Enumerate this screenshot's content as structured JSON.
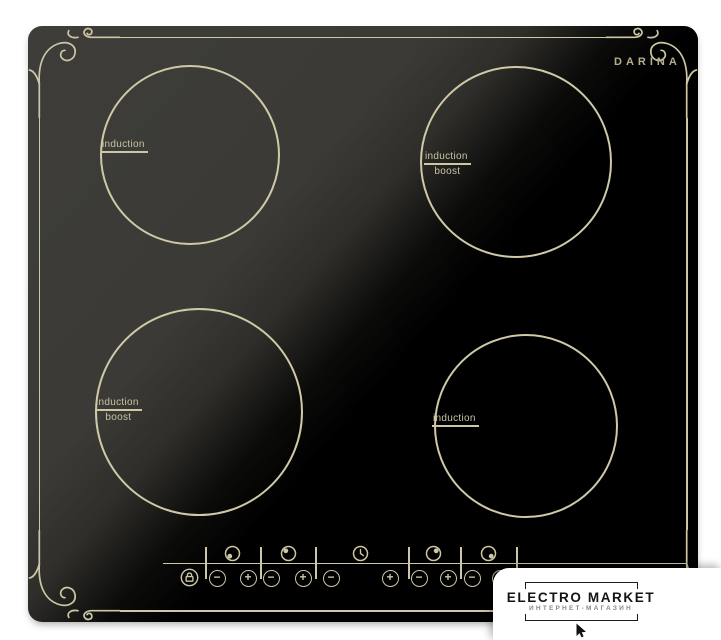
{
  "brand": "DARINA",
  "zones": [
    {
      "id": "rear-left",
      "type_label": "induction",
      "boost_label": ""
    },
    {
      "id": "rear-right",
      "type_label": "induction",
      "boost_label": "boost"
    },
    {
      "id": "front-left",
      "type_label": "induction",
      "boost_label": "boost"
    },
    {
      "id": "front-right",
      "type_label": "induction",
      "boost_label": ""
    }
  ],
  "control_panel": {
    "minus_label": "−",
    "plus_label": "+",
    "icons": {
      "lock": "padlock-icon",
      "timer": "clock-icon",
      "zone_indicators": [
        "dot-bottom-left",
        "dot-top-left",
        "dot-top-right",
        "dot-bottom-right"
      ]
    }
  },
  "watermark": {
    "title": "ELECTRO MARKET",
    "subtitle": "ИНТЕРНЕТ-МАГАЗИН"
  },
  "colors": {
    "accent": "#cdc7a5",
    "brand_text": "#b5ae8e",
    "surface_gray": "#3c3b38",
    "surface_black": "#000000",
    "watermark_bg": "#ffffff",
    "watermark_text": "#1c1c1c",
    "watermark_subtext": "#8a8a8a"
  }
}
